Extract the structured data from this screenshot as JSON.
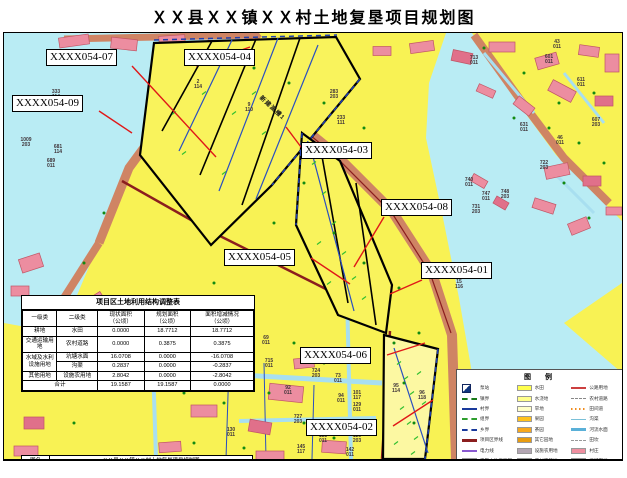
{
  "title": "ＸＸ县ＸＸ镇ＸＸ村土地复垦项目规划图",
  "colors": {
    "water": "#b9ecf4",
    "farmland": "#f8f254",
    "project_parcel": "#fcf8a2",
    "building_pink": "#ec8da0",
    "road_salmon": "#cf8464",
    "boundary_road_red": "#8b1e1e",
    "channel_blue": "#2a4fc0",
    "leader_red": "#e01818"
  },
  "map": {
    "annotation": "新建渡槽1",
    "callouts": [
      {
        "label": "XXXX054-07"
      },
      {
        "label": "XXXX054-04"
      },
      {
        "label": "XXXX054-09"
      },
      {
        "label": "XXXX054-03"
      },
      {
        "label": "XXXX054-08"
      },
      {
        "label": "XXXX054-05"
      },
      {
        "label": "XXXX054-01"
      },
      {
        "label": "XXXX054-06"
      },
      {
        "label": "XXXX054-02"
      }
    ],
    "parcel_labels": [
      {
        "t": "333/114",
        "x": 52,
        "y": 62
      },
      {
        "t": "1009/203",
        "x": 22,
        "y": 110
      },
      {
        "t": "681/114",
        "x": 54,
        "y": 117
      },
      {
        "t": "689/011",
        "x": 47,
        "y": 131
      },
      {
        "t": "2/114",
        "x": 194,
        "y": 52
      },
      {
        "t": "9/110",
        "x": 245,
        "y": 75
      },
      {
        "t": "283/203",
        "x": 330,
        "y": 62
      },
      {
        "t": "233/111",
        "x": 337,
        "y": 88
      },
      {
        "t": "713/011",
        "x": 470,
        "y": 28
      },
      {
        "t": "43/011",
        "x": 553,
        "y": 12
      },
      {
        "t": "601/011",
        "x": 545,
        "y": 27
      },
      {
        "t": "611/011",
        "x": 577,
        "y": 50
      },
      {
        "t": "607/203",
        "x": 592,
        "y": 90
      },
      {
        "t": "631/011",
        "x": 520,
        "y": 95
      },
      {
        "t": "46/011",
        "x": 556,
        "y": 108
      },
      {
        "t": "722/203",
        "x": 540,
        "y": 133
      },
      {
        "t": "740/011",
        "x": 465,
        "y": 150
      },
      {
        "t": "747/011",
        "x": 482,
        "y": 164
      },
      {
        "t": "748/203",
        "x": 501,
        "y": 162
      },
      {
        "t": "731/203",
        "x": 472,
        "y": 177
      },
      {
        "t": "15/116",
        "x": 455,
        "y": 252
      },
      {
        "t": "69/011",
        "x": 262,
        "y": 308
      },
      {
        "t": "715/011",
        "x": 265,
        "y": 331
      },
      {
        "t": "724/203",
        "x": 312,
        "y": 341
      },
      {
        "t": "73/011",
        "x": 334,
        "y": 346
      },
      {
        "t": "92/011",
        "x": 284,
        "y": 358
      },
      {
        "t": "94/011",
        "x": 337,
        "y": 366
      },
      {
        "t": "101/117",
        "x": 353,
        "y": 363
      },
      {
        "t": "129/011",
        "x": 353,
        "y": 375
      },
      {
        "t": "727/203",
        "x": 294,
        "y": 387
      },
      {
        "t": "95/114",
        "x": 392,
        "y": 356
      },
      {
        "t": "96/118",
        "x": 418,
        "y": 363
      },
      {
        "t": "133/011",
        "x": 319,
        "y": 406
      },
      {
        "t": "120/203",
        "x": 353,
        "y": 406
      },
      {
        "t": "130/011",
        "x": 227,
        "y": 400
      },
      {
        "t": "145/117",
        "x": 297,
        "y": 417
      },
      {
        "t": "142/011",
        "x": 346,
        "y": 420
      }
    ]
  },
  "adjustment_table": {
    "title": "项目区土地利用结构调整表",
    "headers": [
      "一级类",
      "二级类",
      "现状面积（公顷）",
      "规划面积（公顷）",
      "面积增减情况（公顷）"
    ],
    "rows": [
      {
        "l1": "耕地",
        "l1span": 1,
        "l2": "水田",
        "current": "0.0000",
        "planned": "18.7712",
        "change": "18.7712"
      },
      {
        "l1": "交通运输用地",
        "l1span": 1,
        "l2": "农村道路",
        "current": "0.0000",
        "planned": "0.3875",
        "change": "0.3875"
      },
      {
        "l1": "水域及水利设施用地",
        "l1span": 2,
        "l2": "坑塘水面",
        "current": "16.0708",
        "planned": "0.0000",
        "change": "-16.0708"
      },
      {
        "l1": null,
        "l2": "沟渠",
        "current": "0.2837",
        "planned": "0.0000",
        "change": "-0.2837"
      },
      {
        "l1": "其他用地",
        "l1span": 1,
        "l2": "设施农用地",
        "current": "2.8042",
        "planned": "0.0000",
        "change": "-2.8042"
      }
    ],
    "total": {
      "label": "合计",
      "current": "19.1587",
      "planned": "19.1587",
      "change": "0.0000"
    }
  },
  "info_table": {
    "name_label": "图名",
    "name_value": "ＸＸ县ＸＸ镇ＸＸ村土地复垦项目规划图",
    "unit_label": "单位",
    "unit_value": "江苏省××地理信息测绘股份有限公司",
    "drafter_label": "制图",
    "drafter_value": "×××",
    "date_label": "日期",
    "date_value": "2018年7月"
  },
  "legend": {
    "title": "图 例",
    "col1": [
      {
        "sw": "pump",
        "c": "#10357e",
        "label": "泵站"
      },
      {
        "sw": "dashline",
        "c": "#1a7a1a",
        "w": 2,
        "label": "镇界"
      },
      {
        "sw": "line",
        "c": "#1a3a9c",
        "w": 2,
        "label": "村界"
      },
      {
        "sw": "dashline",
        "c": "#2f9e2f",
        "w": 2,
        "label": "组界"
      },
      {
        "sw": "dashline",
        "c": "#1a3a9c",
        "w": 2,
        "label": "乡界"
      },
      {
        "sw": "line",
        "c": "#8b1e1e",
        "w": 3,
        "label": "项目区界线"
      },
      {
        "sw": "line",
        "c": "#8a5ad0",
        "w": 2,
        "label": "电力线"
      },
      {
        "sw": "rect",
        "c": "#ffff5e",
        "label": "平整土地工程区"
      },
      {
        "sw": "rect-dot",
        "c": "#ffff5e",
        "label": "新增耕地"
      },
      {
        "sw": "rect-dashed",
        "c": "#ffffff",
        "label": "项目区范围"
      },
      {
        "sw": "rect-white",
        "c": "#ffffff",
        "label": "其他"
      }
    ],
    "col2": [
      {
        "sw": "rect",
        "c": "#ffff4d",
        "label": "水田"
      },
      {
        "sw": "rect",
        "c": "#ffff8c",
        "label": "水浇地"
      },
      {
        "sw": "rect",
        "c": "#ffffc8",
        "label": "旱地"
      },
      {
        "sw": "rect",
        "c": "#ffc21e",
        "label": "果园"
      },
      {
        "sw": "rect",
        "c": "#f7a81e",
        "label": "茶园"
      },
      {
        "sw": "rect",
        "c": "#e89c10",
        "label": "其它园地"
      },
      {
        "sw": "rect",
        "c": "#b3a6b3",
        "label": "设施农用地"
      },
      {
        "sw": "rect",
        "c": "#a03a42",
        "label": "农村宅基地"
      },
      {
        "sw": "rect",
        "c": "#f2a7b8",
        "label": "其他建设用地"
      },
      {
        "sw": "rect",
        "c": "#e05a6a",
        "label": "城市"
      },
      {
        "sw": "rect",
        "c": "#e05a6a",
        "label": "建制镇"
      }
    ],
    "col3": [
      {
        "sw": "line",
        "c": "#cc4040",
        "w": 2,
        "label": "公路用地"
      },
      {
        "sw": "dashline",
        "c": "#888888",
        "w": 1,
        "label": "农村道路"
      },
      {
        "sw": "dotline",
        "c": "#f08c1e",
        "label": "田间道"
      },
      {
        "sw": "line",
        "c": "#7ac0d8",
        "w": 1,
        "label": "沟渠"
      },
      {
        "sw": "line",
        "c": "#5ab0d8",
        "w": 3,
        "label": "河流水面"
      },
      {
        "sw": "dashline",
        "c": "#999999",
        "w": 1,
        "label": "田坎"
      },
      {
        "sw": "rect",
        "c": "#ef8fa0",
        "label": "村庄"
      },
      {
        "sw": "rect",
        "c": "#e25b6a",
        "label": "采矿用地"
      },
      {
        "sw": "rect",
        "c": "#e25b6a",
        "label": "风景名胜及特殊用地"
      }
    ]
  }
}
